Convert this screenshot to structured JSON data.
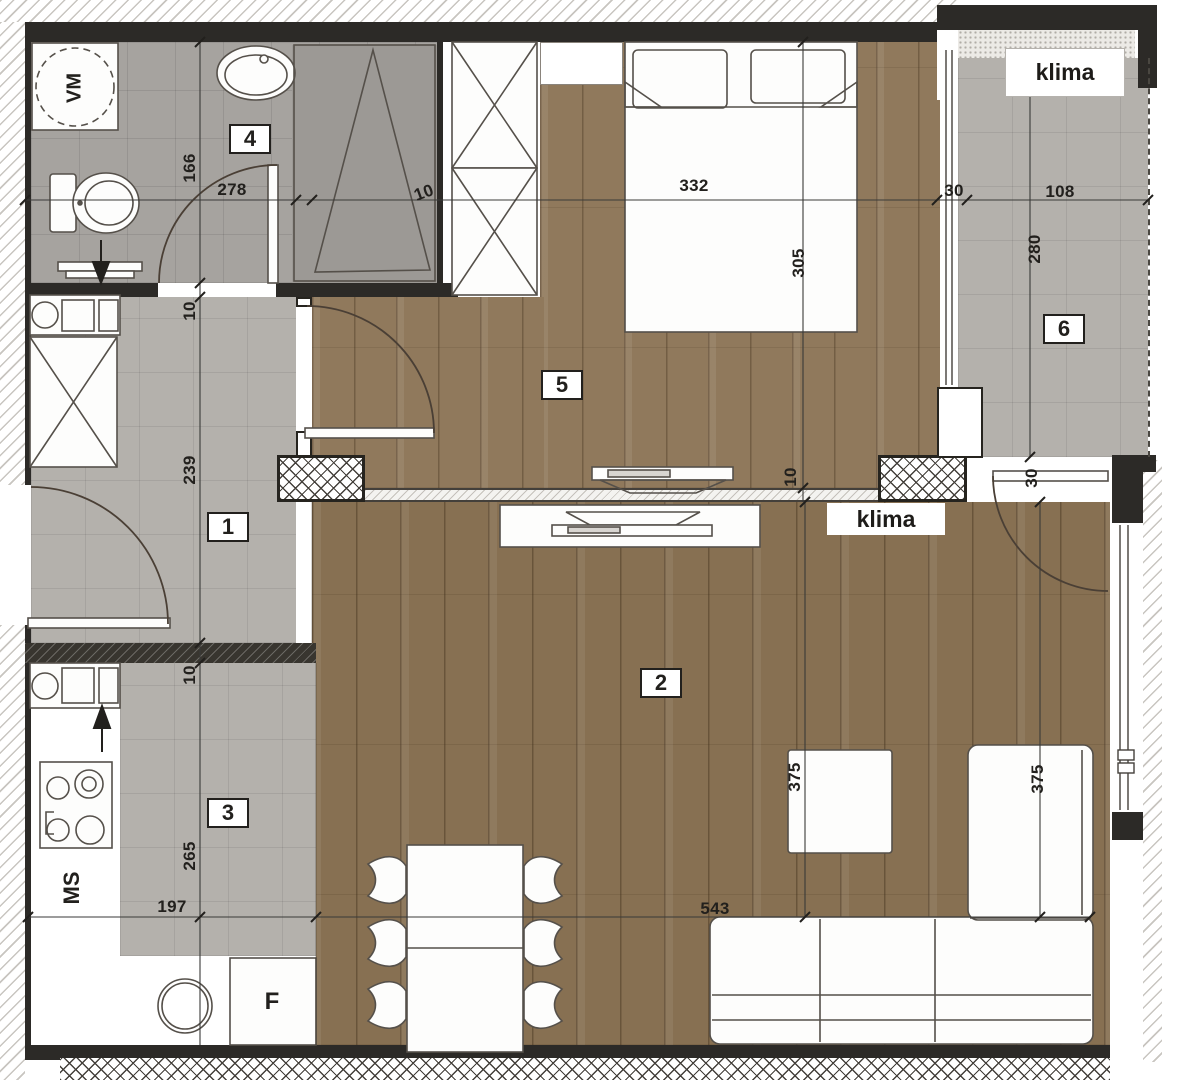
{
  "title": "apartment floor plan",
  "labels": {
    "klima_terrace": "klima",
    "klima_living": "klima",
    "washing_machine": "VM",
    "dishwasher": "MS",
    "fridge": "F"
  },
  "rooms": [
    {
      "number": "1",
      "x": 228,
      "y": 527
    },
    {
      "number": "2",
      "x": 661,
      "y": 683
    },
    {
      "number": "3",
      "x": 228,
      "y": 813
    },
    {
      "number": "4",
      "x": 250,
      "y": 139
    },
    {
      "number": "5",
      "x": 562,
      "y": 385
    },
    {
      "number": "6",
      "x": 1064,
      "y": 329
    }
  ],
  "dimensions": [
    {
      "text": "166",
      "x": 190,
      "y": 168,
      "rot": -90
    },
    {
      "text": "278",
      "x": 232,
      "y": 190,
      "rot": 0
    },
    {
      "text": "10",
      "x": 424,
      "y": 193,
      "rot": -20
    },
    {
      "text": "332",
      "x": 694,
      "y": 186,
      "rot": 0
    },
    {
      "text": "30",
      "x": 954,
      "y": 191,
      "rot": 0
    },
    {
      "text": "108",
      "x": 1060,
      "y": 192,
      "rot": 0
    },
    {
      "text": "305",
      "x": 799,
      "y": 263,
      "rot": -90
    },
    {
      "text": "280",
      "x": 1035,
      "y": 249,
      "rot": -90
    },
    {
      "text": "10",
      "x": 190,
      "y": 311,
      "rot": -90
    },
    {
      "text": "239",
      "x": 190,
      "y": 470,
      "rot": -90
    },
    {
      "text": "10",
      "x": 190,
      "y": 675,
      "rot": -90
    },
    {
      "text": "265",
      "x": 190,
      "y": 856,
      "rot": -90
    },
    {
      "text": "197",
      "x": 172,
      "y": 907,
      "rot": 0
    },
    {
      "text": "543",
      "x": 715,
      "y": 909,
      "rot": 0
    },
    {
      "text": "10",
      "x": 791,
      "y": 477,
      "rot": -90
    },
    {
      "text": "30",
      "x": 1032,
      "y": 478,
      "rot": -90
    },
    {
      "text": "375",
      "x": 795,
      "y": 777,
      "rot": -90
    },
    {
      "text": "375",
      "x": 1038,
      "y": 779,
      "rot": -90
    }
  ],
  "colors": {
    "wall": "#2c2a27",
    "tile_floor": "#b4b1ac",
    "bathroom_tile": "#a6a39f",
    "wood_bedroom": "#90795c",
    "wood_living": "#877052",
    "furniture_stroke": "#55504a"
  }
}
